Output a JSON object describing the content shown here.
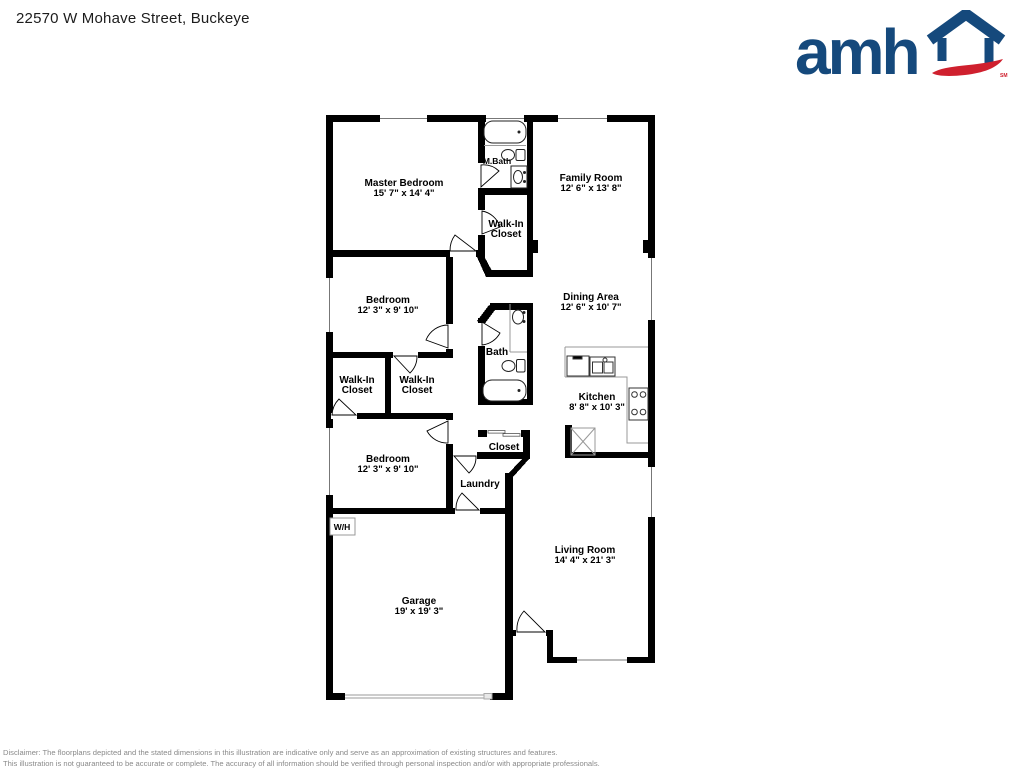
{
  "page": {
    "title": "22570 W Mohave Street, Buckeye",
    "disclaimer_line1": "Disclaimer: The floorplans depicted and the stated dimensions in this illustration are indicative only and serve as an approximation of existing structures and features.",
    "disclaimer_line2": "This illustration is not guaranteed to be accurate or complete. The accuracy of all information should be verified through personal inspection and/or with appropriate professionals."
  },
  "logo": {
    "wordmark": "amh",
    "service_mark": "SM",
    "house_icon": "house-icon",
    "colors": {
      "blue": "#15497c",
      "red": "#cf202e"
    }
  },
  "floorplan": {
    "labels": {
      "master_bedroom": {
        "name": "Master Bedroom",
        "dims": "15' 7\" x 14' 4\""
      },
      "m_bath": {
        "name": "M.Bath"
      },
      "family_room": {
        "name": "Family Room",
        "dims": "12' 6\" x 13' 8\""
      },
      "master_closet": {
        "line1": "Walk-In",
        "line2": "Closet"
      },
      "bedroom_1": {
        "name": "Bedroom",
        "dims": "12' 3\" x 9' 10\""
      },
      "dining_area": {
        "name": "Dining Area",
        "dims": "12' 6\" x 10' 7\""
      },
      "bath": {
        "name": "Bath"
      },
      "closet_left": {
        "line1": "Walk-In",
        "line2": "Closet"
      },
      "closet_right": {
        "line1": "Walk-In",
        "line2": "Closet"
      },
      "kitchen": {
        "name": "Kitchen",
        "dims": "8' 8\" x 10' 3\""
      },
      "bedroom_2": {
        "name": "Bedroom",
        "dims": "12' 3\" x 9' 10\""
      },
      "closet": {
        "name": "Closet"
      },
      "laundry": {
        "name": "Laundry"
      },
      "water_heater": {
        "name": "W/H"
      },
      "living_room": {
        "name": "Living Room",
        "dims": "14' 4\" x 21' 3\""
      },
      "garage": {
        "name": "Garage",
        "dims": "19' x 19' 3\""
      }
    }
  }
}
